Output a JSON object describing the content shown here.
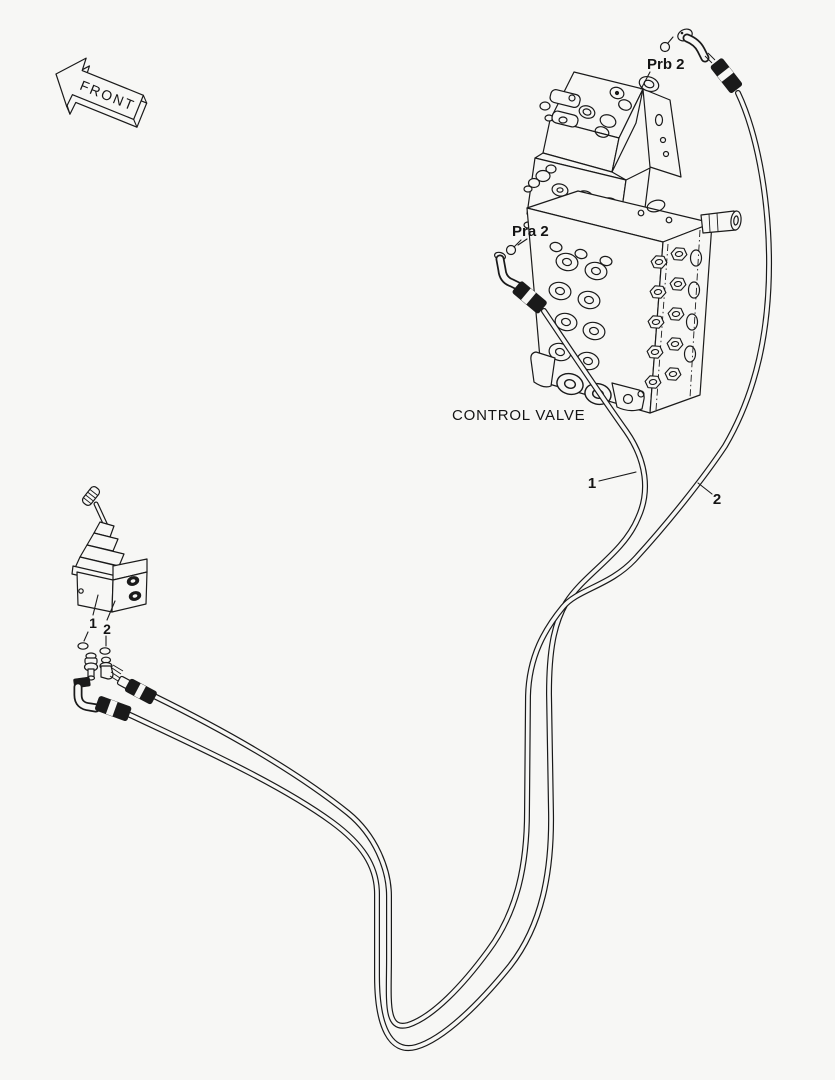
{
  "diagram": {
    "background": "#f7f7f5",
    "line_color": "#1a1a1a",
    "labels": {
      "front": "FRONT",
      "prb2": "Prb 2",
      "pra2": "Pra 2",
      "control_valve": "CONTROL VALVE",
      "hose_1": "1",
      "hose_2": "2",
      "item_1": "1",
      "item_2": "2"
    }
  }
}
